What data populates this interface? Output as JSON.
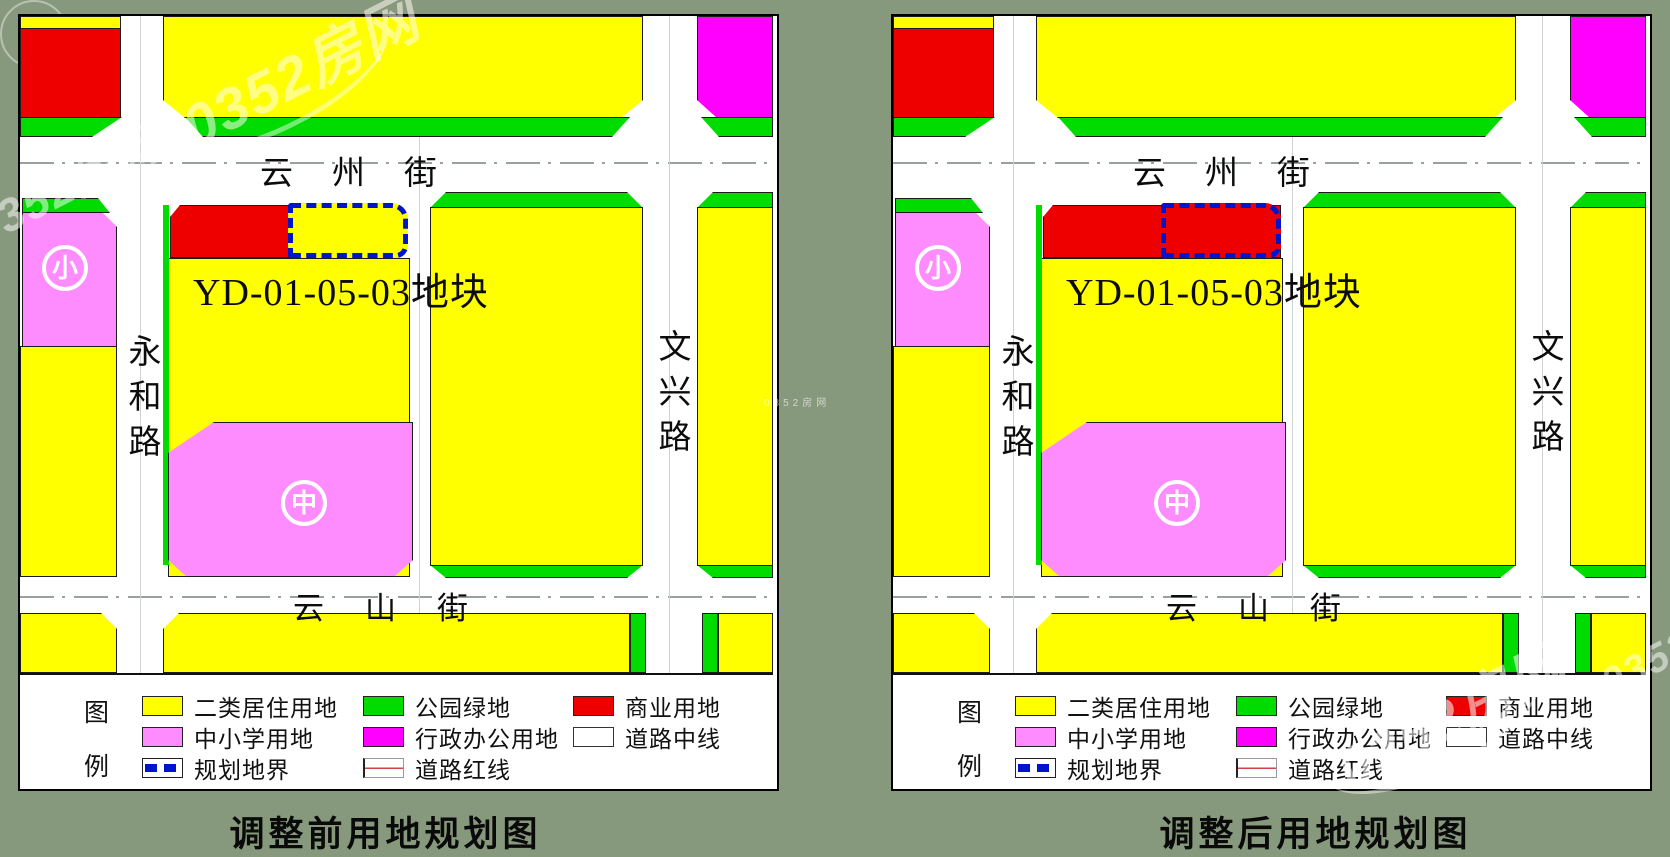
{
  "palette": {
    "background": "#87997C",
    "yellow": "#FFFF00",
    "green": "#00DC00",
    "red": "#EE0000",
    "pink": "#FF8CFF",
    "magenta": "#FF00FF",
    "boundary_blue": "#0014CC",
    "road_white": "#FFFFFF",
    "ink": "#111111"
  },
  "streets": {
    "top": "云州街",
    "bottom": "云山街",
    "left": "永和路",
    "right": "文兴路"
  },
  "plot": {
    "label": "YD-01-05-03地块",
    "small_school_marker": "小",
    "middle_school_marker": "中"
  },
  "legend": {
    "title_chars": [
      "图",
      "例"
    ],
    "items": {
      "residential": {
        "label": "二类居住用地",
        "color": "#FFFF00"
      },
      "school": {
        "label": "中小学用地",
        "color": "#FF8CFF"
      },
      "boundary": {
        "label": "规划地界",
        "color": "#0014CC"
      },
      "park": {
        "label": "公园绿地",
        "color": "#00DC00"
      },
      "admin": {
        "label": "行政办公用地",
        "color": "#FF00FF"
      },
      "road_redline": {
        "label": "道路红线",
        "color": "#CC4444"
      },
      "commercial": {
        "label": "商业用地",
        "color": "#EE0000"
      },
      "road_centerline": {
        "label": "道路中线",
        "color": "#FFFFFF"
      }
    }
  },
  "maps": [
    {
      "caption": "调整前用地规划图",
      "boundary_style": "--fill:#FFFF00"
    },
    {
      "caption": "调整后用地规划图",
      "boundary_style": "--fill:#EE0000"
    }
  ],
  "watermark": {
    "text": "0352房网"
  }
}
